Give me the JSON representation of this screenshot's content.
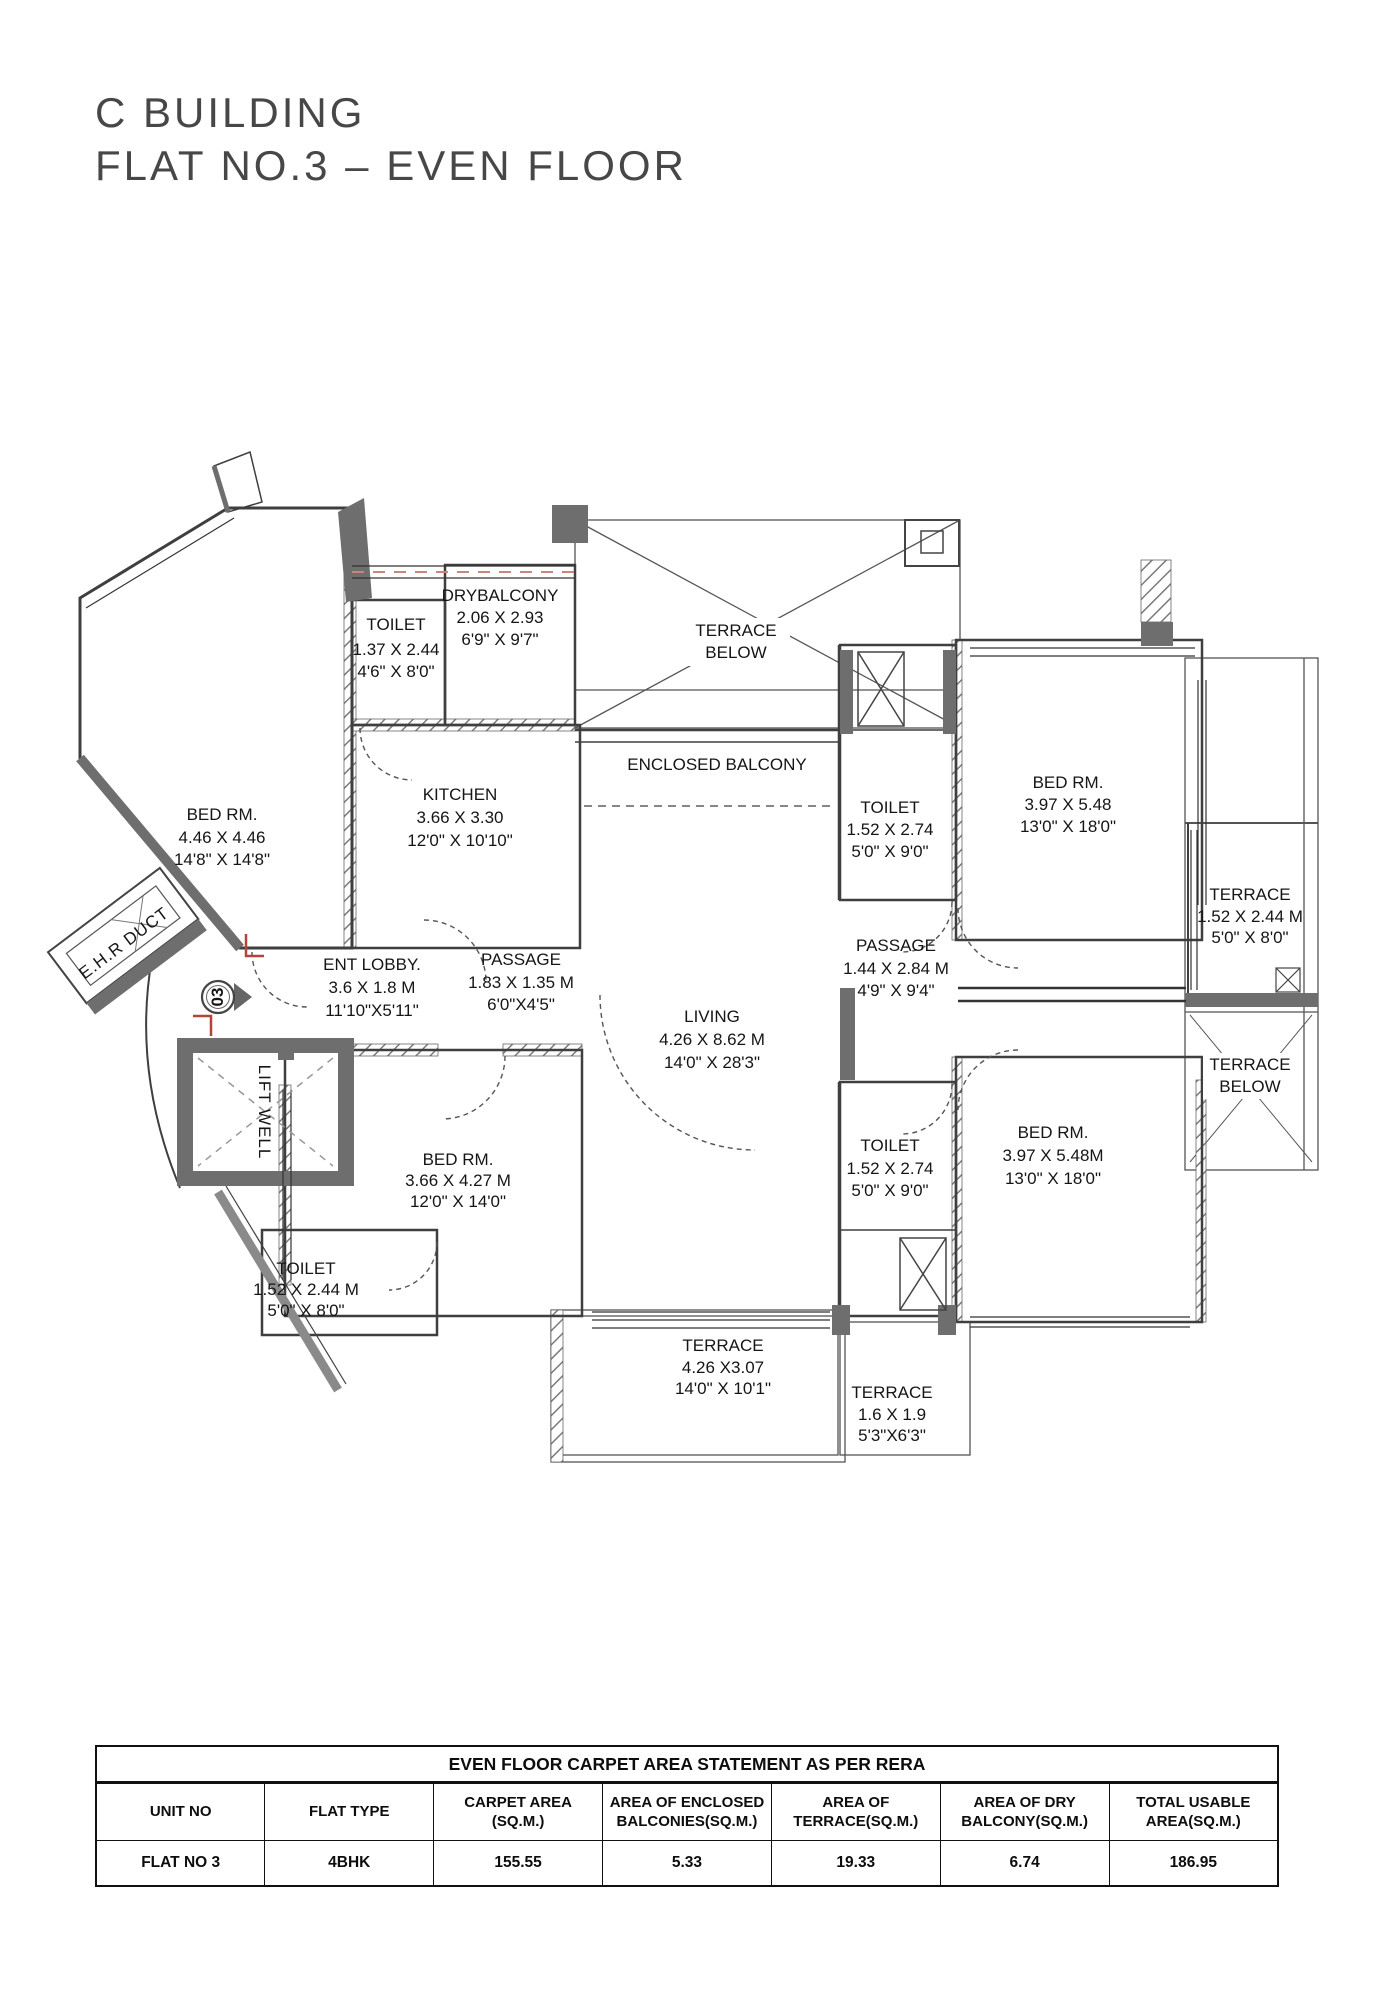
{
  "page": {
    "title_line1": "C BUILDING",
    "title_line2": "FLAT NO.3 – EVEN FLOOR"
  },
  "plan": {
    "labels": [
      {
        "id": "toilet-upper-left",
        "lines": [
          "TOILET",
          "1.37 X 2.44",
          "4'6\" X 8'0\""
        ]
      },
      {
        "id": "dry-balcony",
        "lines": [
          "DRYBALCONY",
          "2.06 X 2.93",
          "6'9\" X 9'7\""
        ]
      },
      {
        "id": "terrace-below-top",
        "lines": [
          "TERRACE",
          "BELOW"
        ]
      },
      {
        "id": "enclosed-balcony",
        "lines": [
          "ENCLOSED BALCONY"
        ]
      },
      {
        "id": "bed-room-left",
        "lines": [
          "BED RM.",
          "4.46 X 4.46",
          "14'8\" X 14'8\""
        ]
      },
      {
        "id": "kitchen",
        "lines": [
          "KITCHEN",
          "3.66 X 3.30",
          "12'0\" X 10'10\""
        ]
      },
      {
        "id": "toilet-upper-mid",
        "lines": [
          "TOILET",
          "1.52 X 2.74",
          "5'0\" X 9'0\""
        ]
      },
      {
        "id": "bed-room-top-right",
        "lines": [
          "BED RM.",
          "3.97 X 5.48",
          "13'0\" X 18'0\""
        ]
      },
      {
        "id": "terrace-right",
        "lines": [
          "TERRACE",
          "1.52 X 2.44 M",
          "5'0\" X 8'0\""
        ]
      },
      {
        "id": "entrance-lobby",
        "lines": [
          "ENT LOBBY.",
          "3.6 X 1.8 M",
          "11'10\"X5'11\""
        ]
      },
      {
        "id": "passage-left",
        "lines": [
          "PASSAGE",
          "1.83 X 1.35 M",
          "6'0\"X4'5\""
        ]
      },
      {
        "id": "living",
        "lines": [
          "LIVING",
          "4.26 X 8.62 M",
          "14'0\" X 28'3\""
        ]
      },
      {
        "id": "passage-right",
        "lines": [
          "PASSAGE",
          "1.44 X 2.84 M",
          "4'9\" X 9'4\""
        ]
      },
      {
        "id": "terrace-below-right",
        "lines": [
          "TERRACE",
          "BELOW"
        ]
      },
      {
        "id": "lift-well",
        "lines": [
          "LIFT WELL"
        ]
      },
      {
        "id": "bed-room-bottom-left",
        "lines": [
          "BED RM.",
          "3.66 X 4.27 M",
          "12'0\" X 14'0\""
        ]
      },
      {
        "id": "toilet-bottom-mid",
        "lines": [
          "TOILET",
          "1.52 X 2.74",
          "5'0\" X 9'0\""
        ]
      },
      {
        "id": "bed-room-bottom-right",
        "lines": [
          "BED RM.",
          "3.97 X 5.48M",
          "13'0\" X 18'0\""
        ]
      },
      {
        "id": "toilet-bottom-left",
        "lines": [
          "TOILET",
          "1.52 X 2.44 M",
          "5'0\" X 8'0\""
        ]
      },
      {
        "id": "terrace-bottom",
        "lines": [
          "TERRACE",
          "4.26 X3.07",
          "14'0\" X 10'1\""
        ]
      },
      {
        "id": "terrace-bottom-small",
        "lines": [
          "TERRACE",
          "1.6 X 1.9",
          "5'3\"X6'3\""
        ]
      },
      {
        "id": "ehr-duct",
        "lines": [
          "E.H.R DUCT"
        ]
      },
      {
        "id": "unit-marker",
        "lines": [
          "03"
        ]
      }
    ]
  },
  "table": {
    "title": "EVEN FLOOR CARPET AREA STATEMENT AS PER RERA",
    "headers": [
      {
        "l1": "UNIT NO",
        "l2": ""
      },
      {
        "l1": "FLAT TYPE",
        "l2": ""
      },
      {
        "l1": "CARPET AREA",
        "l2": "(SQ.M.)"
      },
      {
        "l1": "AREA OF ENCLOSED",
        "l2": "BALCONIES(SQ.M.)"
      },
      {
        "l1": "AREA OF",
        "l2": "TERRACE(SQ.M.)"
      },
      {
        "l1": "AREA OF DRY",
        "l2": "BALCONY(SQ.M.)"
      },
      {
        "l1": "TOTAL USABLE",
        "l2": "AREA(SQ.M.)"
      }
    ],
    "row": [
      "FLAT NO 3",
      "4BHK",
      "155.55",
      "5.33",
      "19.33",
      "6.74",
      "186.95"
    ]
  }
}
